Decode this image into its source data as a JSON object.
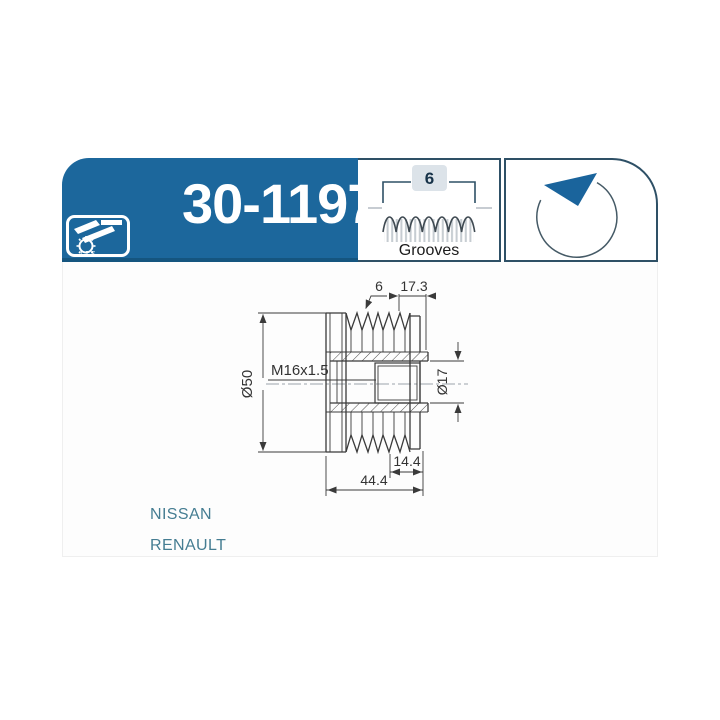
{
  "header": {
    "part_number": "30-1197",
    "logo": {
      "brand": "I.J.S.",
      "icon": "ijs-gear-logo"
    },
    "grooves": {
      "count": "6",
      "label": "Grooves",
      "icon": "belt-grooves-profile"
    },
    "rotation": {
      "icon": "rotation-counterclockwise-arrow"
    }
  },
  "drawing": {
    "dimensions": {
      "grooves_count": "6",
      "groove_section_width": "17.3",
      "thread": "M16x1.5",
      "outer_diameter": "Ø50",
      "bore_diameter": "Ø17",
      "hub_width": "14.4",
      "total_width": "44.4"
    }
  },
  "applications": [
    "NISSAN",
    "RENAULT"
  ],
  "colors": {
    "brand_blue": "#1C679C",
    "brand_blue_dark": "#15557F",
    "panel_border": "#2E5066",
    "application_text": "#457D92",
    "drawing_line": "#3a3a3a"
  }
}
